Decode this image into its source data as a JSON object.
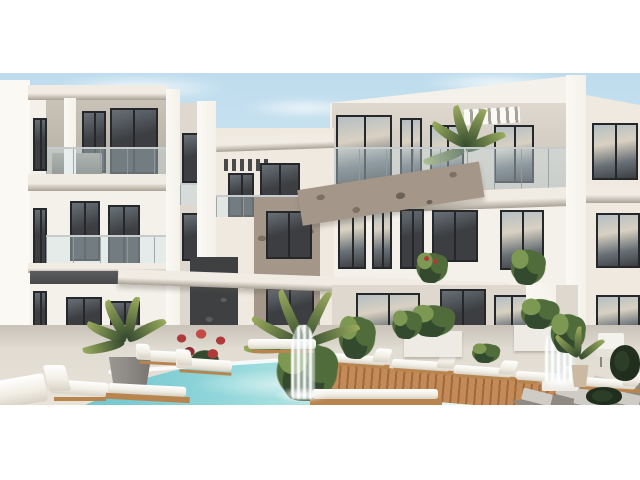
{
  "scene": {
    "type": "architectural-exterior-render",
    "caption": "Modern white three-storey apartment complex around a courtyard swimming pool with wooden deck, rows of sun loungers, potted palms, red bougainvillea, white water fountains and stepping stones under a pale blue sky",
    "letterbox": "white bars above and below the photograph"
  },
  "palette": {
    "letterbox": "#ffffff",
    "sky_top": "#bedcee",
    "sky_mid": "#d3e7f1",
    "sky_low": "#e9f2f4",
    "cloud": "#f6fafc",
    "wall_lit": "#f4f1ea",
    "wall_bright": "#fbf9f4",
    "wall_shade": "#ded8ce",
    "wall_warm": "#efe9df",
    "recess": "#c9c2b7",
    "recess_dark": "#b4ada1",
    "slab": "#f1ece3",
    "slab_shadow": "#a8a196",
    "win_dark": "#3c3e41",
    "win_mid": "#687076",
    "win_frame": "#26272a",
    "curtain": "#d9d1c2",
    "glass_reflect": "#b4bec3",
    "stone_light": "#a4978a",
    "stone_dark": "#7d7164",
    "stone_joint": "#6c6257",
    "darkstone": "#3e4042",
    "darkstone_light": "#5a5d5f",
    "rail_post": "#9aa0a4",
    "pergola_dark": "#47494b",
    "terrace": "#e1dcd2",
    "terrace_shade": "#c8c2b8",
    "pool_deep": "#6fc3cd",
    "pool_main": "#90d6da",
    "pool_shallow": "#c4ebe7",
    "pool_light": "#e7f7f3",
    "deck": "#c48b58",
    "deck_dark": "#9d6a3d",
    "cushion": "#f2eee5",
    "cushion_shade": "#d8d2c5",
    "wood": "#b9854f",
    "wood_dark": "#8e6237",
    "leaf_dark": "#344a2e",
    "leaf_mid": "#506c3a",
    "leaf_light": "#7d9852",
    "palm_light": "#9aab5e",
    "flower_red": "#b03a3a",
    "pot_gray": "#8e8b86",
    "pot_beige": "#cbb9a4",
    "planter_white": "#eeebe4",
    "stone_tile": "#cfccc5",
    "tile_gap": "#8e8a81"
  },
  "objects": [
    "sky",
    "clouds",
    "left-apartment-building",
    "center-wing",
    "right-apartment-building",
    "glass-balconies",
    "stone-clad-column",
    "stone-parapet",
    "dark-stone-accent-panel",
    "pergola-slats",
    "balcony-palm",
    "curtained-windows",
    "glass-entrance-door",
    "courtyard-terrace",
    "swimming-pool",
    "wooden-pool-deck",
    "stepping-stones",
    "sun-loungers",
    "white-planters",
    "potted-palms",
    "bougainvillea",
    "shrubs",
    "pool-fountain",
    "wall-fountain",
    "outdoor-chair"
  ]
}
